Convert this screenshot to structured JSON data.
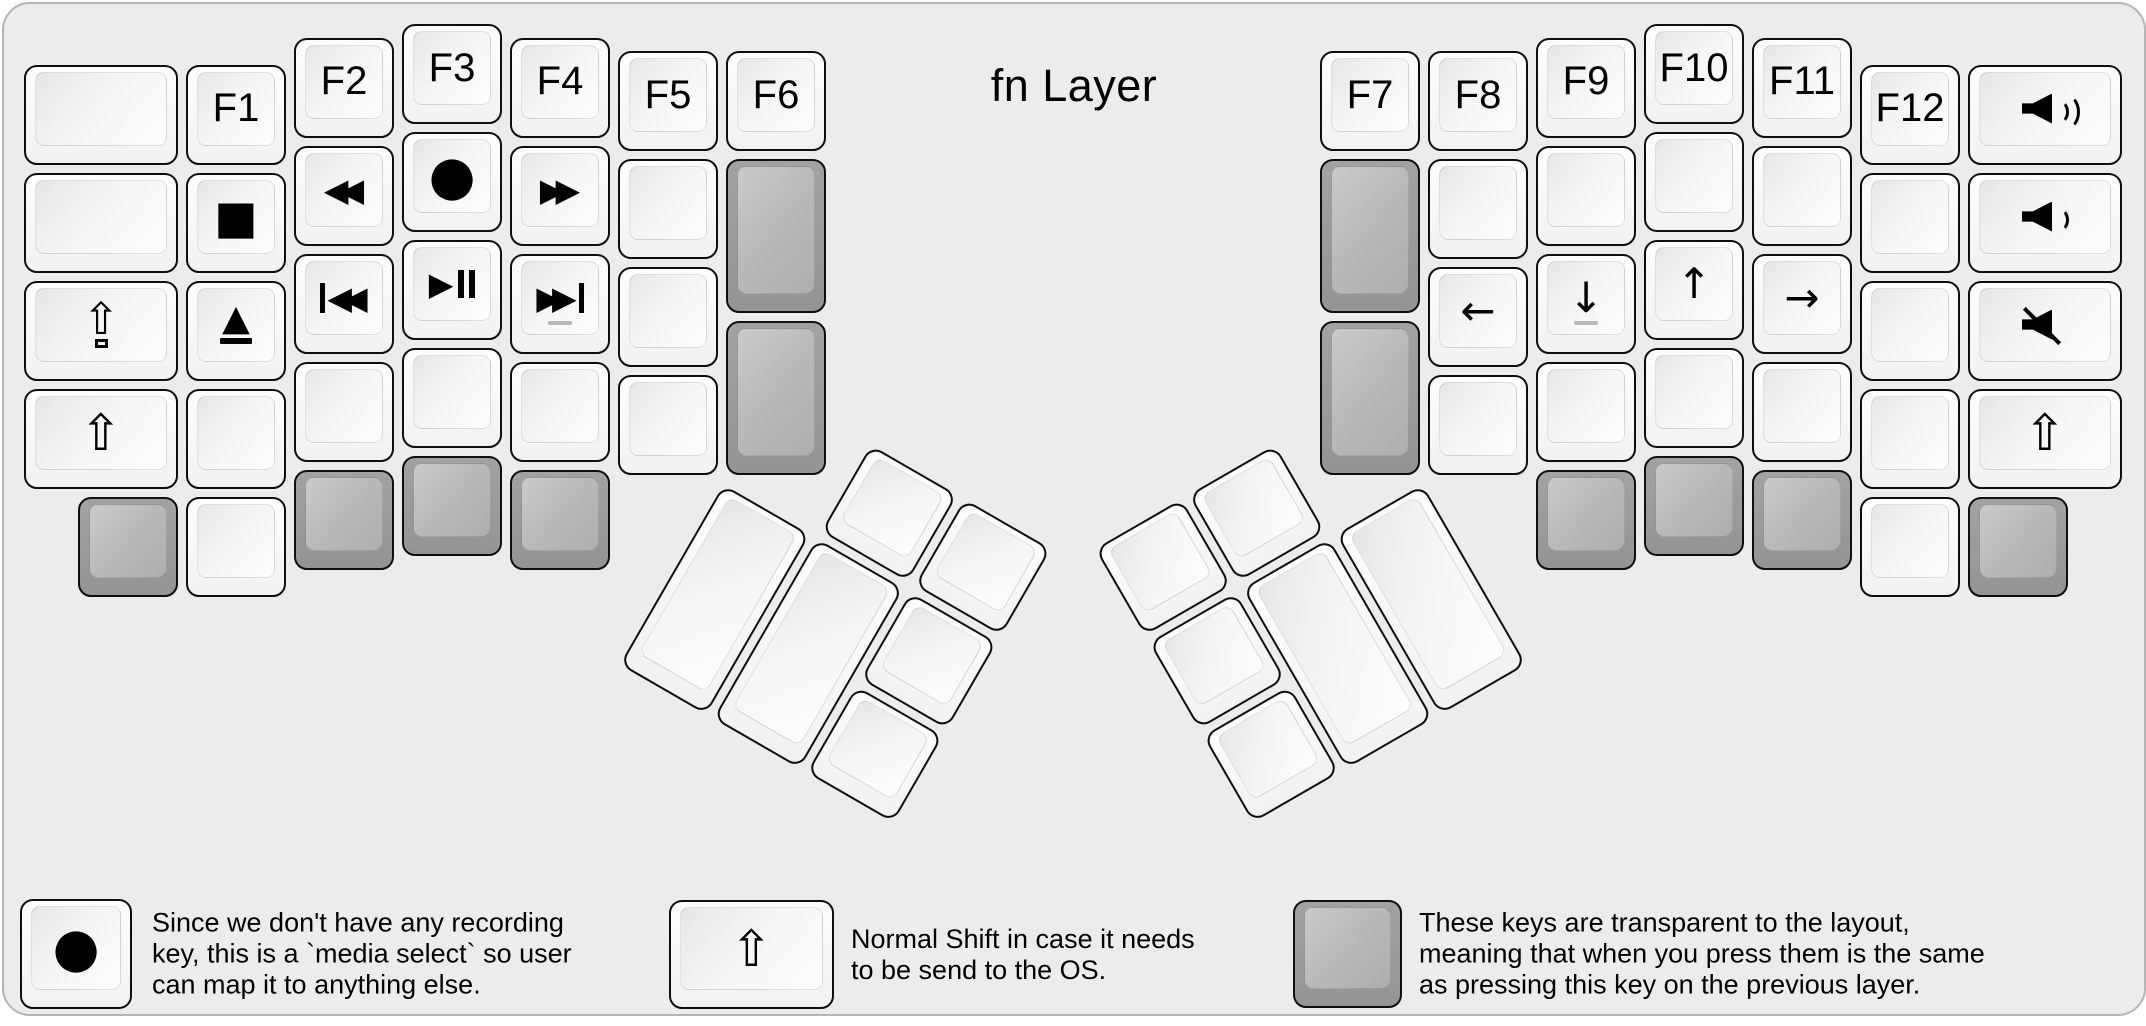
{
  "title": "fn Layer",
  "colors": {
    "canvas_bg": "#ececec",
    "canvas_border": "#b5b5b5",
    "key_border": "#0f0f0f",
    "white_key": "#fbfbfb",
    "gray_key": "#9a9a9a",
    "text": "#000000",
    "homing_dash": "#b9b9b9"
  },
  "keyboard": {
    "unit_px": 108,
    "clusters": [
      {
        "name": "left-main",
        "origin": [
          16,
          16
        ],
        "rotation": 0,
        "keys": [
          {
            "x": 0,
            "y": 0.375,
            "w": 1.5,
            "color": "white",
            "icon": "blank",
            "name": "key-blank"
          },
          {
            "x": 0,
            "y": 1.375,
            "w": 1.5,
            "color": "white",
            "icon": "blank",
            "name": "key-blank"
          },
          {
            "x": 0,
            "y": 2.375,
            "w": 1.5,
            "color": "white",
            "icon": "caps",
            "name": "key-caps-lock"
          },
          {
            "x": 0,
            "y": 3.375,
            "w": 1.5,
            "color": "white",
            "icon": "shift",
            "name": "key-shift"
          },
          {
            "x": 1.5,
            "y": 0.375,
            "color": "white",
            "label": "F1",
            "name": "key-f1"
          },
          {
            "x": 1.5,
            "y": 1.375,
            "color": "white",
            "icon": "stop",
            "name": "key-stop"
          },
          {
            "x": 1.5,
            "y": 2.375,
            "color": "white",
            "icon": "eject",
            "name": "key-eject"
          },
          {
            "x": 1.5,
            "y": 3.375,
            "color": "white",
            "icon": "blank",
            "name": "key-blank"
          },
          {
            "x": 1.5,
            "y": 4.375,
            "color": "white",
            "icon": "blank",
            "name": "key-blank"
          },
          {
            "x": 0.5,
            "y": 4.375,
            "color": "gray",
            "icon": "blank",
            "name": "key-transparent"
          },
          {
            "x": 2.5,
            "y": 0.125,
            "color": "white",
            "label": "F2",
            "name": "key-f2"
          },
          {
            "x": 2.5,
            "y": 1.125,
            "color": "white",
            "icon": "rewind",
            "name": "key-rewind"
          },
          {
            "x": 2.5,
            "y": 2.125,
            "color": "white",
            "icon": "prev",
            "name": "key-prev-track"
          },
          {
            "x": 2.5,
            "y": 3.125,
            "color": "white",
            "icon": "blank",
            "name": "key-blank"
          },
          {
            "x": 2.5,
            "y": 4.125,
            "color": "gray",
            "icon": "blank",
            "name": "key-transparent"
          },
          {
            "x": 3.5,
            "y": 0,
            "color": "white",
            "label": "F3",
            "name": "key-f3"
          },
          {
            "x": 3.5,
            "y": 1,
            "color": "white",
            "icon": "record",
            "name": "key-record"
          },
          {
            "x": 3.5,
            "y": 2,
            "color": "white",
            "icon": "playpause",
            "name": "key-play-pause"
          },
          {
            "x": 3.5,
            "y": 3,
            "color": "white",
            "icon": "blank",
            "name": "key-blank"
          },
          {
            "x": 3.5,
            "y": 4,
            "color": "gray",
            "icon": "blank",
            "name": "key-transparent"
          },
          {
            "x": 4.5,
            "y": 0.125,
            "color": "white",
            "label": "F4",
            "name": "key-f4"
          },
          {
            "x": 4.5,
            "y": 1.125,
            "color": "white",
            "icon": "ffwd",
            "name": "key-fast-forward"
          },
          {
            "x": 4.5,
            "y": 2.125,
            "color": "white",
            "icon": "next",
            "homing": true,
            "name": "key-next-track"
          },
          {
            "x": 4.5,
            "y": 3.125,
            "color": "white",
            "icon": "blank",
            "name": "key-blank"
          },
          {
            "x": 4.5,
            "y": 4.125,
            "color": "gray",
            "icon": "blank",
            "name": "key-transparent"
          },
          {
            "x": 5.5,
            "y": 0.25,
            "color": "white",
            "label": "F5",
            "name": "key-f5"
          },
          {
            "x": 5.5,
            "y": 1.25,
            "color": "white",
            "icon": "blank",
            "name": "key-blank"
          },
          {
            "x": 5.5,
            "y": 2.25,
            "color": "white",
            "icon": "blank",
            "name": "key-blank"
          },
          {
            "x": 5.5,
            "y": 3.25,
            "color": "white",
            "icon": "blank",
            "name": "key-blank"
          },
          {
            "x": 6.5,
            "y": 0.25,
            "color": "white",
            "label": "F6",
            "name": "key-f6"
          },
          {
            "x": 6.5,
            "y": 1.25,
            "h": 1.5,
            "color": "gray",
            "icon": "blank",
            "name": "key-transparent"
          },
          {
            "x": 6.5,
            "y": 2.75,
            "h": 1.5,
            "color": "gray",
            "icon": "blank",
            "name": "key-transparent"
          }
        ]
      },
      {
        "name": "right-main",
        "origin": [
          16,
          16
        ],
        "rotation": 0,
        "keys": [
          {
            "x": 12,
            "y": 0.25,
            "color": "white",
            "label": "F7",
            "name": "key-f7"
          },
          {
            "x": 12,
            "y": 1.25,
            "h": 1.5,
            "color": "gray",
            "icon": "blank",
            "name": "key-transparent"
          },
          {
            "x": 12,
            "y": 2.75,
            "h": 1.5,
            "color": "gray",
            "icon": "blank",
            "name": "key-transparent"
          },
          {
            "x": 13,
            "y": 0.25,
            "color": "white",
            "label": "F8",
            "name": "key-f8"
          },
          {
            "x": 13,
            "y": 1.25,
            "color": "white",
            "icon": "blank",
            "name": "key-blank"
          },
          {
            "x": 13,
            "y": 2.25,
            "color": "white",
            "icon": "arrow-left",
            "name": "key-arrow-left"
          },
          {
            "x": 13,
            "y": 3.25,
            "color": "white",
            "icon": "blank",
            "name": "key-blank"
          },
          {
            "x": 14,
            "y": 0.125,
            "color": "white",
            "label": "F9",
            "name": "key-f9"
          },
          {
            "x": 14,
            "y": 1.125,
            "color": "white",
            "icon": "blank",
            "name": "key-blank"
          },
          {
            "x": 14,
            "y": 2.125,
            "color": "white",
            "icon": "arrow-down",
            "homing": true,
            "name": "key-arrow-down"
          },
          {
            "x": 14,
            "y": 3.125,
            "color": "white",
            "icon": "blank",
            "name": "key-blank"
          },
          {
            "x": 14,
            "y": 4.125,
            "color": "gray",
            "icon": "blank",
            "name": "key-transparent"
          },
          {
            "x": 15,
            "y": 0,
            "color": "white",
            "label": "F10",
            "name": "key-f10"
          },
          {
            "x": 15,
            "y": 1,
            "color": "white",
            "icon": "blank",
            "name": "key-blank"
          },
          {
            "x": 15,
            "y": 2,
            "color": "white",
            "icon": "arrow-up",
            "name": "key-arrow-up"
          },
          {
            "x": 15,
            "y": 3,
            "color": "white",
            "icon": "blank",
            "name": "key-blank"
          },
          {
            "x": 15,
            "y": 4,
            "color": "gray",
            "icon": "blank",
            "name": "key-transparent"
          },
          {
            "x": 16,
            "y": 0.125,
            "color": "white",
            "label": "F11",
            "name": "key-f11"
          },
          {
            "x": 16,
            "y": 1.125,
            "color": "white",
            "icon": "blank",
            "name": "key-blank"
          },
          {
            "x": 16,
            "y": 2.125,
            "color": "white",
            "icon": "arrow-right",
            "name": "key-arrow-right"
          },
          {
            "x": 16,
            "y": 3.125,
            "color": "white",
            "icon": "blank",
            "name": "key-blank"
          },
          {
            "x": 16,
            "y": 4.125,
            "color": "gray",
            "icon": "blank",
            "name": "key-transparent"
          },
          {
            "x": 17,
            "y": 0.375,
            "color": "white",
            "label": "F12",
            "name": "key-f12"
          },
          {
            "x": 17,
            "y": 1.375,
            "color": "white",
            "icon": "blank",
            "name": "key-blank"
          },
          {
            "x": 17,
            "y": 2.375,
            "color": "white",
            "icon": "blank",
            "name": "key-blank"
          },
          {
            "x": 17,
            "y": 3.375,
            "color": "white",
            "icon": "blank",
            "name": "key-blank"
          },
          {
            "x": 17,
            "y": 4.375,
            "color": "white",
            "icon": "blank",
            "name": "key-blank"
          },
          {
            "x": 18,
            "y": 0.375,
            "w": 1.5,
            "color": "white",
            "icon": "vol-up",
            "name": "key-volume-up"
          },
          {
            "x": 18,
            "y": 1.375,
            "w": 1.5,
            "color": "white",
            "icon": "vol-down",
            "name": "key-volume-down"
          },
          {
            "x": 18,
            "y": 2.375,
            "w": 1.5,
            "color": "white",
            "icon": "mute",
            "name": "key-mute"
          },
          {
            "x": 18,
            "y": 3.375,
            "w": 1.5,
            "color": "white",
            "icon": "shift",
            "name": "key-shift"
          },
          {
            "x": 18,
            "y": 4.375,
            "color": "gray",
            "icon": "blank",
            "name": "key-transparent"
          }
        ]
      },
      {
        "name": "left-thumb",
        "origin": [
          718,
          475
        ],
        "rotation": 30,
        "keys": [
          {
            "x": 1,
            "y": -1,
            "color": "white",
            "icon": "blank",
            "name": "key-blank"
          },
          {
            "x": 2,
            "y": -1,
            "color": "white",
            "icon": "blank",
            "name": "key-blank"
          },
          {
            "x": 0,
            "y": 0,
            "h": 2,
            "color": "white",
            "icon": "blank",
            "name": "key-blank"
          },
          {
            "x": 1,
            "y": 0,
            "h": 2,
            "color": "white",
            "icon": "blank",
            "name": "key-blank"
          },
          {
            "x": 2,
            "y": 0,
            "color": "white",
            "icon": "blank",
            "name": "key-blank"
          },
          {
            "x": 2,
            "y": 1,
            "color": "white",
            "icon": "blank",
            "name": "key-blank"
          }
        ]
      },
      {
        "name": "right-thumb",
        "origin": [
          1420,
          475
        ],
        "rotation": -30,
        "keys": [
          {
            "x": -3,
            "y": -1,
            "color": "white",
            "icon": "blank",
            "name": "key-blank"
          },
          {
            "x": -2,
            "y": -1,
            "color": "white",
            "icon": "blank",
            "name": "key-blank"
          },
          {
            "x": -3,
            "y": 0,
            "color": "white",
            "icon": "blank",
            "name": "key-blank"
          },
          {
            "x": -2,
            "y": 0,
            "h": 2,
            "color": "white",
            "icon": "blank",
            "name": "key-blank"
          },
          {
            "x": -1,
            "y": 0,
            "h": 2,
            "color": "white",
            "icon": "blank",
            "name": "key-blank"
          },
          {
            "x": -3,
            "y": 1,
            "color": "white",
            "icon": "blank",
            "name": "key-blank"
          }
        ]
      }
    ]
  },
  "legend_items": [
    {
      "name": "legend-media-select",
      "key": {
        "x": 16,
        "y": 895,
        "w": 112,
        "h": 110,
        "color": "white",
        "icon": "record"
      },
      "text_x": 148,
      "lines": [
        "Since we don't have any recording",
        "key, this is a `media select` so user",
        "can map it to anything else."
      ]
    },
    {
      "name": "legend-normal-shift",
      "key": {
        "x": 665,
        "y": 896,
        "w": 165,
        "h": 109,
        "color": "white",
        "icon": "shift"
      },
      "text_x": 847,
      "lines": [
        "Normal Shift in case it needs",
        "to be send to the OS."
      ]
    },
    {
      "name": "legend-transparent-keys",
      "key": {
        "x": 1289,
        "y": 896,
        "w": 109,
        "h": 108,
        "color": "gray",
        "icon": "blank"
      },
      "text_x": 1415,
      "lines": [
        "These keys are transparent to the layout,",
        "meaning that when you press them is the same",
        "as pressing this key on the previous layer."
      ]
    }
  ]
}
